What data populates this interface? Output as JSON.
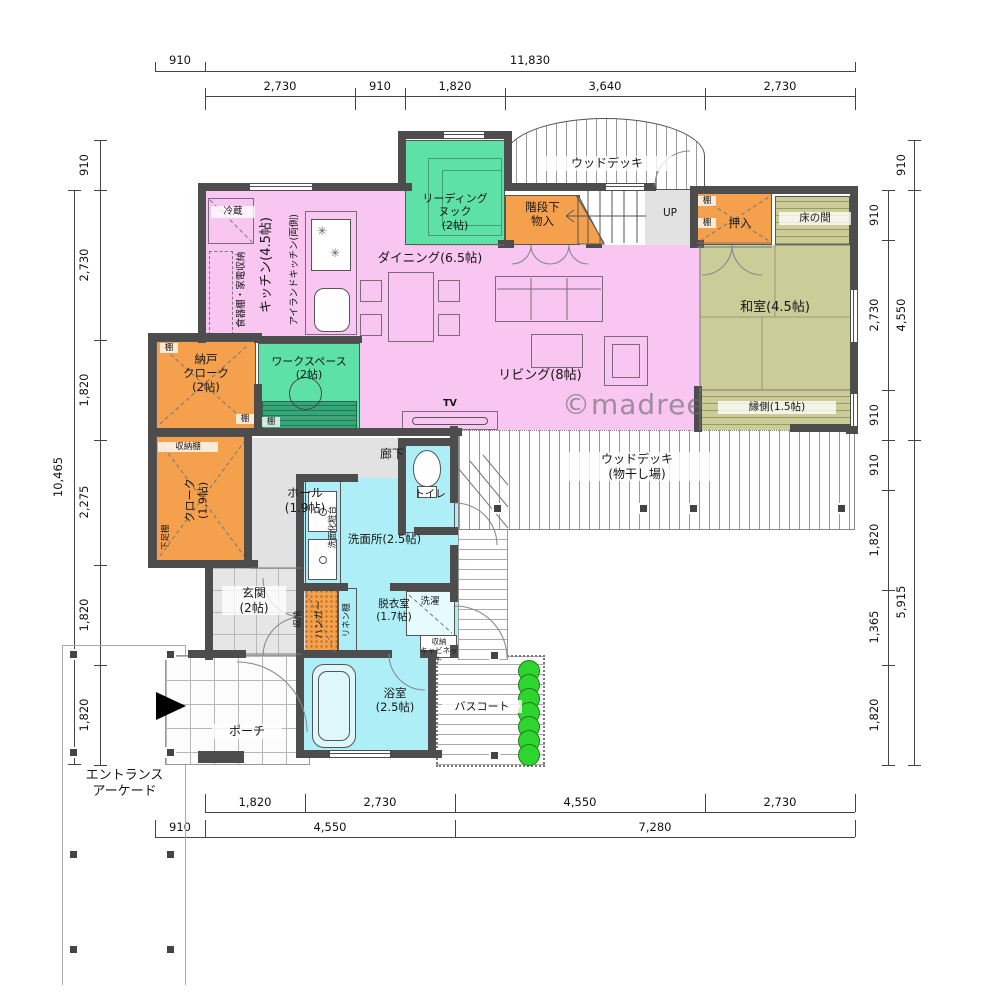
{
  "watermark": "©madree",
  "labels": {
    "up": "UP",
    "tv": "TV",
    "shelf": "棚"
  },
  "rooms": {
    "wood_deck": "ウッドデッキ",
    "reading_nook": "リーディング\nヌック\n(2帖)",
    "stair_storage": "階段下\n物入",
    "oshiire": "押入",
    "tokonoma": "床の間",
    "washitsu": "和室(4.5帖)",
    "engawa": "縁側(1.5帖)",
    "fridge": "冷蔵",
    "kitchen": "キッチン(4.5帖)",
    "island": "アイランドキッチン(両側)",
    "dish_storage": "食器棚・家電収納",
    "dining": "ダイニング(6.5帖)",
    "living": "リビング(8帖)",
    "workspace": "ワークスペース\n(2帖)",
    "nando": "納戸\nクローク\n(2帖)",
    "storage_shelf": "収納棚",
    "cloak": "クローク\n(1.9帖)",
    "shoe_shelf": "下足棚",
    "hall": "ホール\n(1.9帖)",
    "corridor": "廊下",
    "toilet": "トイレ",
    "vanity": "洗面化粧台",
    "senmenjo": "洗面所(2.5帖)",
    "datsui": "脱衣室\n(1.7帖)",
    "laundry": "洗濯",
    "cabinet": "収納\nキャビネット",
    "linen": "リネン棚",
    "hanger": "ハンガー",
    "storage": "収納",
    "genkan": "玄関\n(2帖)",
    "porch": "ポーチ",
    "bath": "浴室\n(2.5帖)",
    "bath_court": "バスコート",
    "deck_laundry": "ウッドデッキ\n(物干し場)",
    "arcade": "エントランス\nアーケード"
  },
  "dims": {
    "top_outer": [
      "910",
      "11,830"
    ],
    "top_inner": [
      "2,730",
      "910",
      "1,820",
      "3,640",
      "2,730"
    ],
    "left_inner": [
      "910",
      "2,730",
      "1,820",
      "2,275",
      "1,820",
      "1,820"
    ],
    "left_outer": [
      "10,465"
    ],
    "right_inner": [
      "910",
      "2,730",
      "910",
      "910",
      "1,820",
      "1,365",
      "1,820"
    ],
    "right_outer": [
      "910",
      "4,550",
      "5,915"
    ],
    "bottom_inner": [
      "1,820",
      "2,730",
      "4,550",
      "2,730"
    ],
    "bottom_outer": [
      "910",
      "4,550",
      "7,280"
    ]
  },
  "colors": {
    "wall": "#4d4d4d",
    "pink": "#f8c6f0",
    "green": "#5de1a6",
    "orange": "#f5a04c",
    "cyan": "#aeeff7",
    "tatami": "#cbcd99",
    "gray": "#e2e2e2",
    "plant": "#2ed52e",
    "desk": "#36a578"
  }
}
